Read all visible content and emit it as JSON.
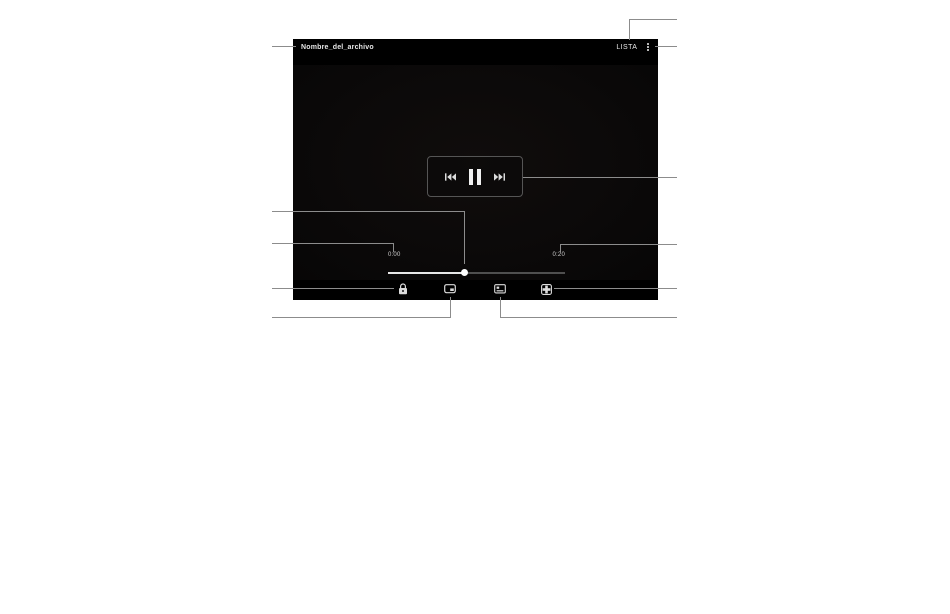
{
  "player": {
    "title": "Nombre_del_archivo",
    "menu_label": "LISTA",
    "elapsed_time": "0:00",
    "total_time": "0:20",
    "progress_percent": 43,
    "state": "playing",
    "icons": {
      "more_options": "kebab-menu-icon",
      "previous": "skip-previous-icon",
      "pause": "pause-icon",
      "next": "skip-next-icon",
      "lock": "lock-icon",
      "popup_player": "popup-player-icon",
      "video_editor": "video-editor-icon",
      "fit_to_screen": "fit-to-screen-icon"
    }
  },
  "colors": {
    "player_bg": "#000000",
    "video_frame": "#0d0b0a",
    "icon": "#e0e0e0",
    "seek_played": "#e8e8e8",
    "seek_track": "#4f4f4f",
    "callout_line": "#8c8c8c",
    "page_bg": "#ffffff"
  }
}
